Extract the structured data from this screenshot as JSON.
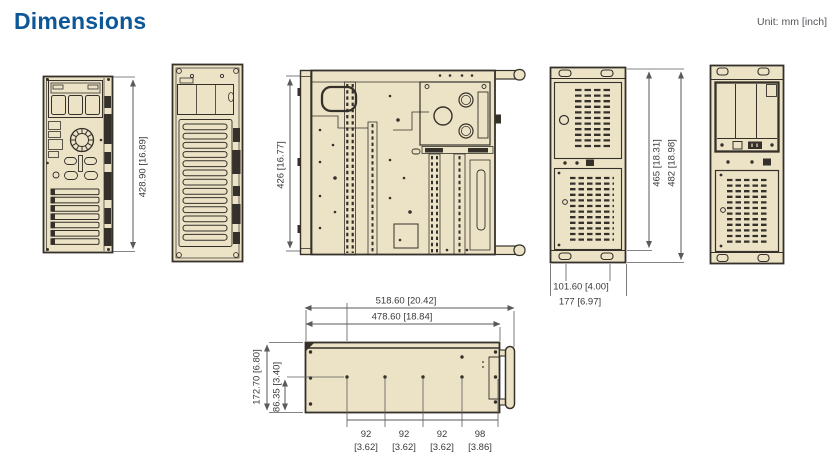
{
  "header": {
    "title": "Dimensions",
    "unit": "Unit: mm [inch]"
  },
  "colors": {
    "accent_blue": "#0d5796",
    "chassis_fill": "#ece3c7",
    "line_dark": "#35312a",
    "dim_gray": "#5a5a5a"
  },
  "dimensions": {
    "rear_height": "428.90 [16.89]",
    "top_depth": "426 [16.77]",
    "side_body_height": "465 [18.31]",
    "side_overall_height": "482 [18.98]",
    "foot_spacing": "101.60 [4.00]",
    "side_depth": "177 [6.97]",
    "bottom_overall_length": "518.60 [20.42]",
    "bottom_body_length": "478.60 [18.84]",
    "bottom_height": "172.70 [6.80]",
    "bottom_half_height": "86.35 [3.40]",
    "hole_spacings": [
      {
        "mm": "92",
        "inch": "[3.62]"
      },
      {
        "mm": "92",
        "inch": "[3.62]"
      },
      {
        "mm": "92",
        "inch": "[3.62]"
      },
      {
        "mm": "98",
        "inch": "[3.86]"
      }
    ]
  }
}
